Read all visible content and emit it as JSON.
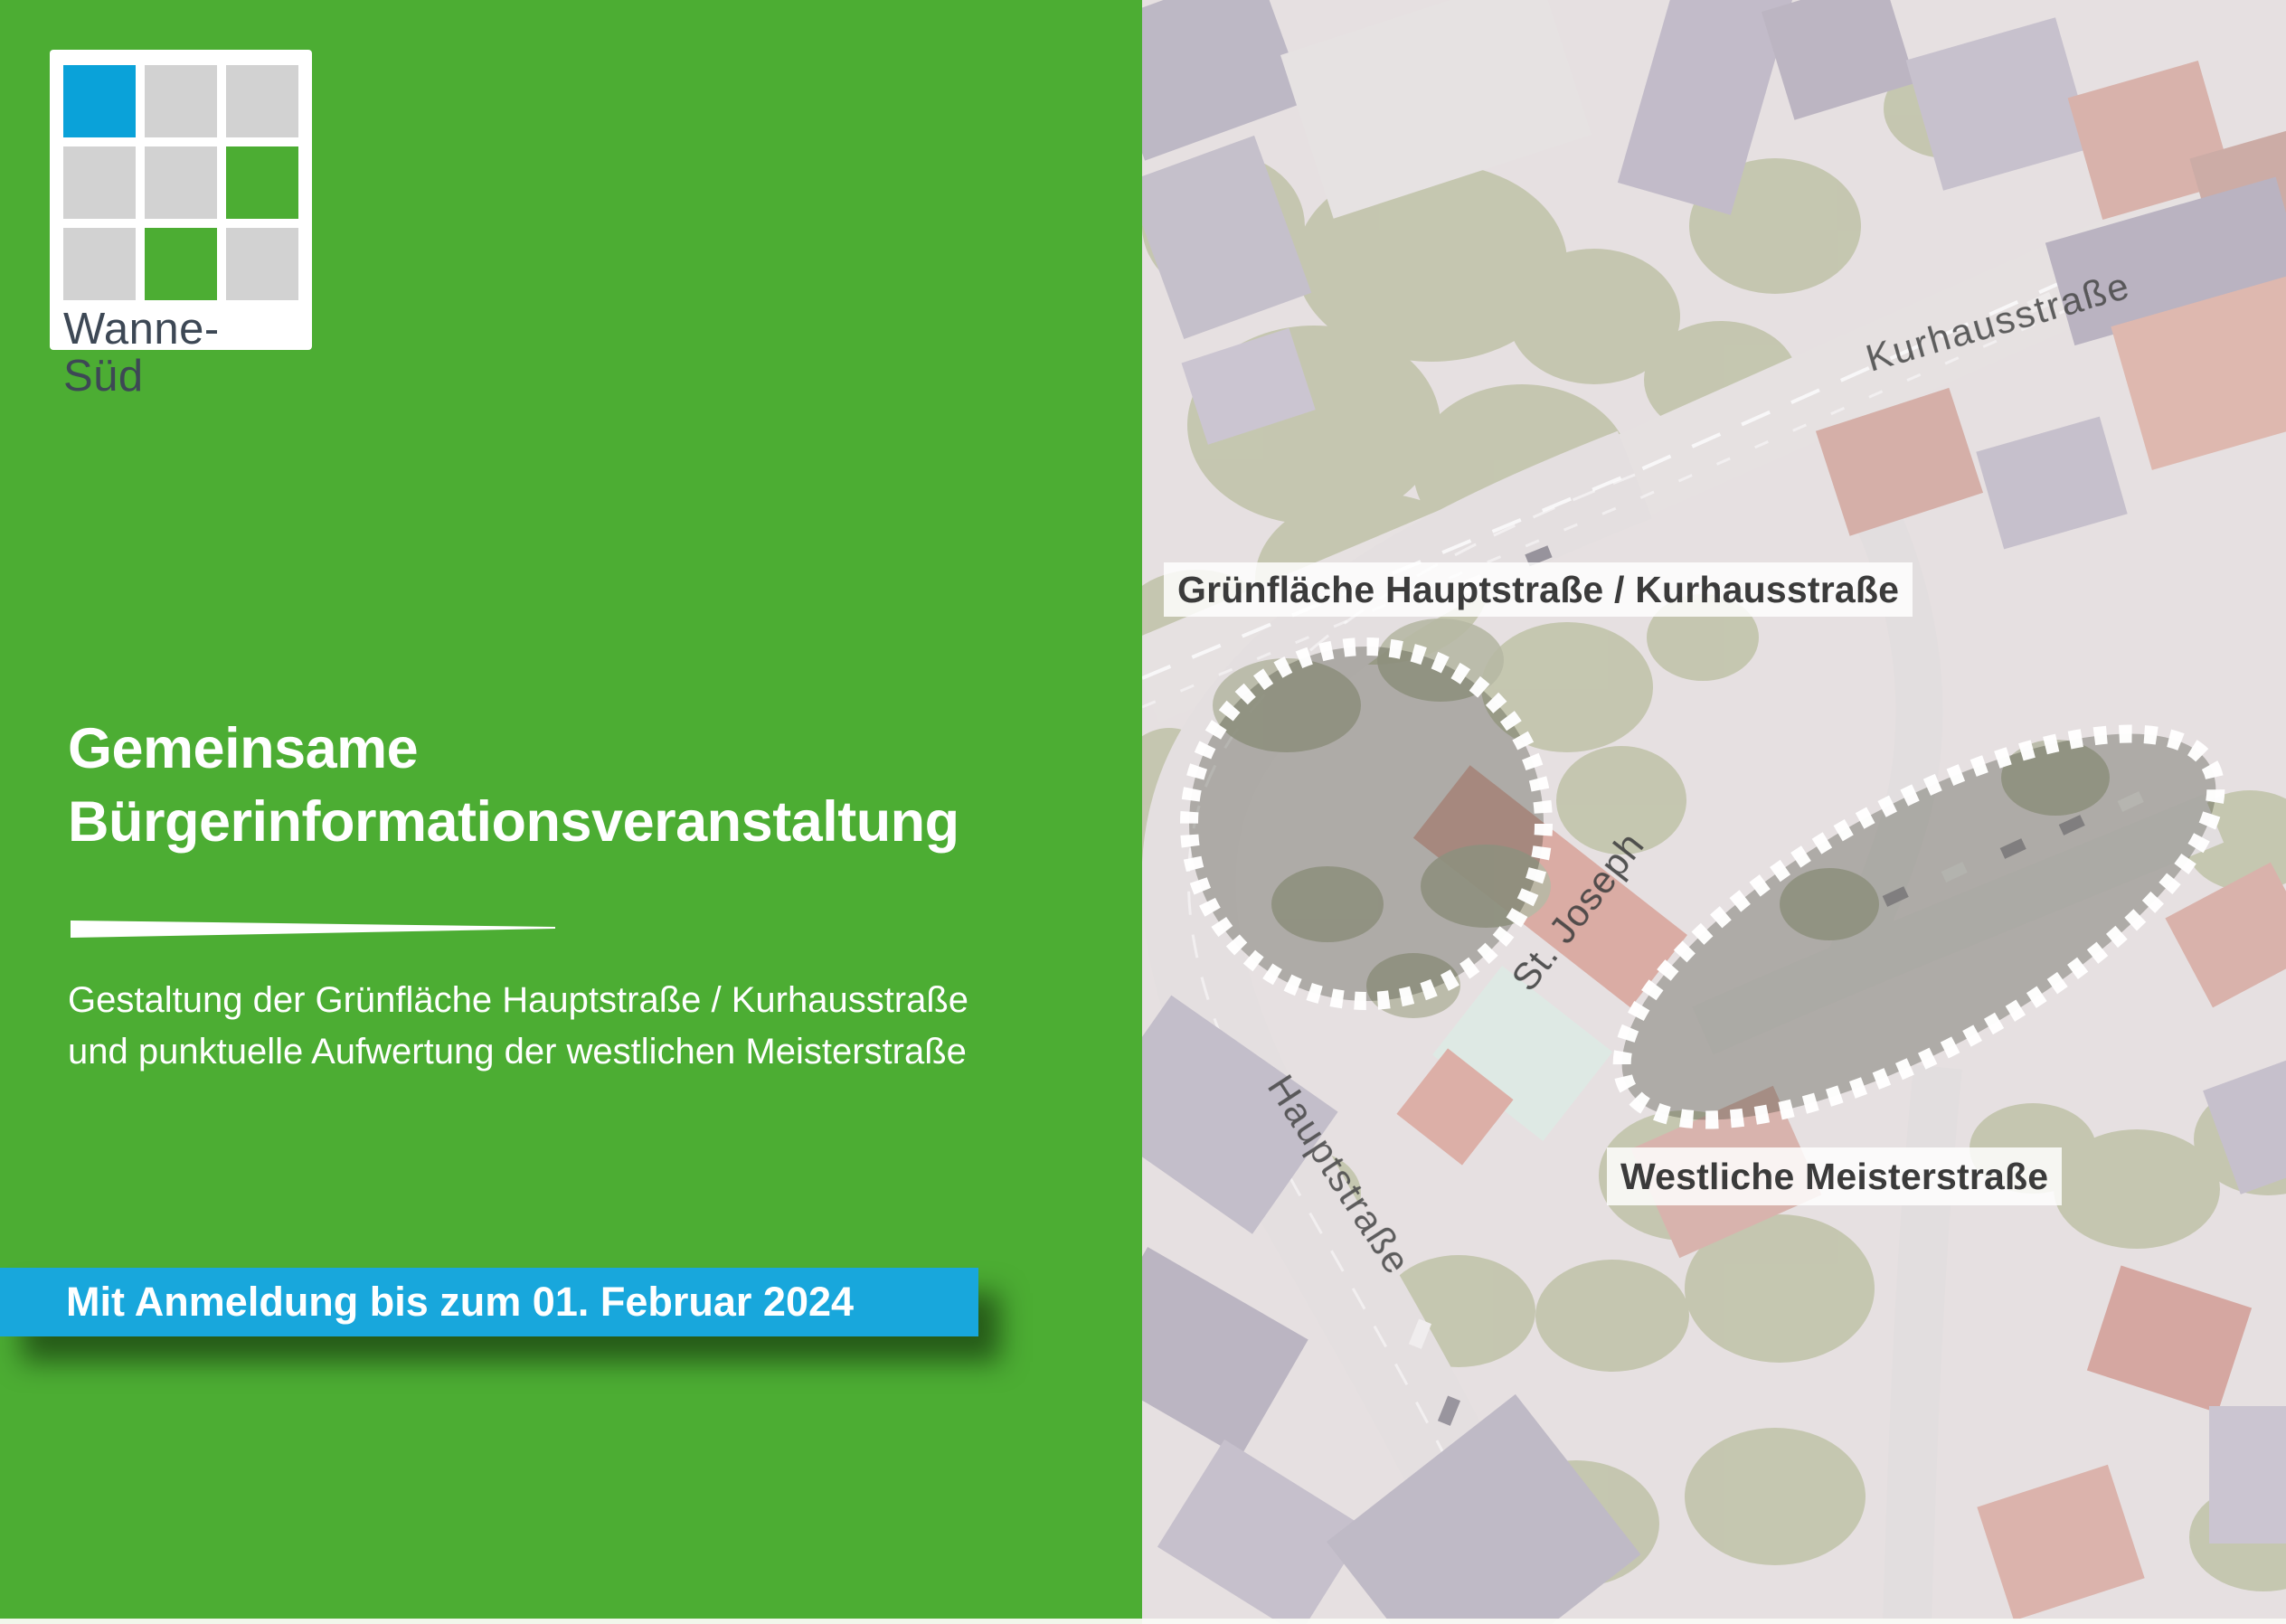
{
  "colors": {
    "panel_green": "#4cad33",
    "banner_blue": "#18a7dc",
    "logo_blue": "#0aa2d9",
    "logo_gray": "#d2d2d2",
    "logo_green": "#4cad33",
    "logo_text": "#3d4855",
    "label_text": "#3b3b3b",
    "street_text": "#4b4b4b"
  },
  "logo": {
    "name": "Wanne-Süd",
    "grid": [
      "blue",
      "gray",
      "gray",
      "gray",
      "gray",
      "green",
      "gray",
      "green",
      "gray"
    ]
  },
  "headline": {
    "line1": "Gemeinsame",
    "line2": "Bürgerinformationsveranstaltung"
  },
  "subtitle": {
    "line1": "Gestaltung der Grünfläche Hauptstraße / Kurhausstraße",
    "line2": "und punktuelle Aufwertung der westlichen Meisterstraße"
  },
  "banner": {
    "text": "Mit Anmeldung bis zum 01. Februar 2024"
  },
  "map": {
    "zone_labels": {
      "green_space": "Grünfläche Hauptstraße / Kurhausstraße",
      "meisterstrasse": "Westliche Meisterstraße"
    },
    "street_labels": {
      "kurhausstrasse": "Kurhausstraße",
      "hauptstrasse": "Hauptstraße",
      "church": "St. Joseph"
    }
  }
}
